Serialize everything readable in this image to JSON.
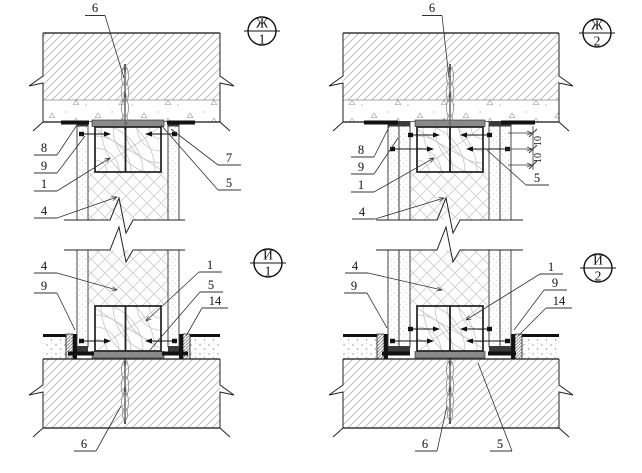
{
  "drawing": {
    "panels": {
      "zh1": {
        "marker": {
          "letter": "Ж",
          "number": "1"
        },
        "callouts": {
          "c6": "6",
          "c8": "8",
          "c9": "9",
          "c1": "1",
          "c4": "4",
          "c7": "7",
          "c5": "5"
        }
      },
      "zh2": {
        "marker": {
          "letter": "Ж",
          "number": "2"
        },
        "callouts": {
          "c6": "6",
          "c8": "8",
          "c9": "9",
          "c1": "1",
          "c4": "4",
          "c5": "5"
        },
        "dimensions": {
          "d1": "10",
          "d2": "10"
        }
      },
      "i1": {
        "marker": {
          "letter": "И",
          "number": "1"
        },
        "callouts": {
          "c4": "4",
          "c9": "9",
          "c1": "1",
          "c5": "5",
          "c14": "14",
          "c6": "6"
        }
      },
      "i2": {
        "marker": {
          "letter": "И",
          "number": "2"
        },
        "callouts": {
          "c4": "4",
          "c9l": "9",
          "c1": "1",
          "c9r": "9",
          "c14": "14",
          "c6": "6",
          "c5": "5"
        }
      }
    },
    "colors": {
      "line": "#1a1a1a",
      "slab_hatch": "#b8b8b8",
      "insulation_crosshatch": "#cfcfcf",
      "damper_strip": "#8a8a8a",
      "black_strip": "#111111",
      "background": "#ffffff"
    }
  }
}
